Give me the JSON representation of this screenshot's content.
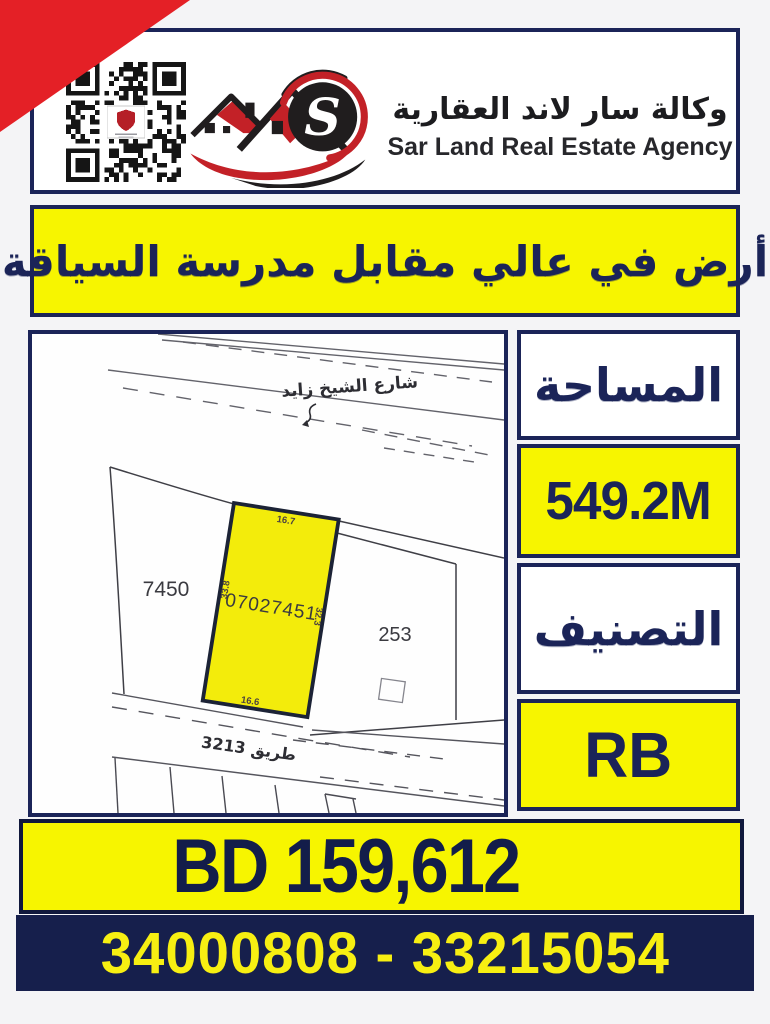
{
  "header": {
    "brand_ar": "وكالة سار لاند العقارية",
    "brand_en": "Sar Land Real Estate Agency"
  },
  "banner": {
    "title": "أرض في عالي مقابل مدرسة السياقة"
  },
  "map": {
    "street_top": "شارع الشيخ زايد",
    "road_bottom": "طريق 3213",
    "plot_id": "07027451",
    "neighbor_left": "7450",
    "neighbor_right": "253",
    "dim_top": "16.7",
    "dim_left": "33.8",
    "dim_right": "32.3",
    "dim_bottom": "16.6"
  },
  "info": {
    "area_label": "المساحة",
    "area_value": "549.2M",
    "class_label": "التصنيف",
    "class_value": "RB"
  },
  "price": {
    "value": "BD 159,612"
  },
  "contact": {
    "phones": "34000808 - 33215054"
  },
  "colors": {
    "red": "#e42026",
    "navy": "#1b2458",
    "yellow": "#f7f500",
    "plot_yellow": "#f3ec0b",
    "phone_band": "#161f4c"
  }
}
